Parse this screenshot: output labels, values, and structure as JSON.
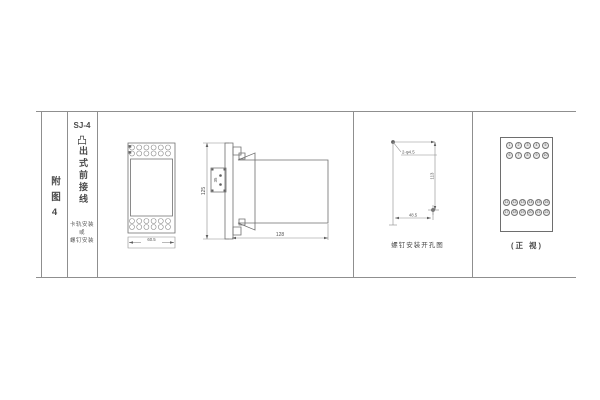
{
  "frame": {
    "line_color": "#8f8f8f"
  },
  "sidebar": {
    "figure_label": "附图4"
  },
  "spec": {
    "model": "SJ-4",
    "protrude_symbol": "凸",
    "wiring_type": "出式前接线",
    "mount_lines": [
      "卡轨安装",
      "或",
      "螺钉安装"
    ]
  },
  "front_view": {
    "width_dim": "60.5"
  },
  "side_view": {
    "height_dim": "125",
    "bracket_dim": "35",
    "depth_dim": "128"
  },
  "drill_view": {
    "holes_label": "2-φ4.5",
    "height_dim": "113",
    "width_dim": "48.5",
    "caption": "螺钉安装开孔图"
  },
  "panel_view": {
    "caption": "(正 视)",
    "row1": [
      "1",
      "2",
      "3",
      "4",
      "5"
    ],
    "row2": [
      "6",
      "7",
      "8",
      "9",
      "10"
    ],
    "row3": [
      "11",
      "12",
      "13",
      "14",
      "15",
      "16"
    ],
    "row4": [
      "17",
      "18",
      "19",
      "20",
      "21",
      "22"
    ]
  }
}
